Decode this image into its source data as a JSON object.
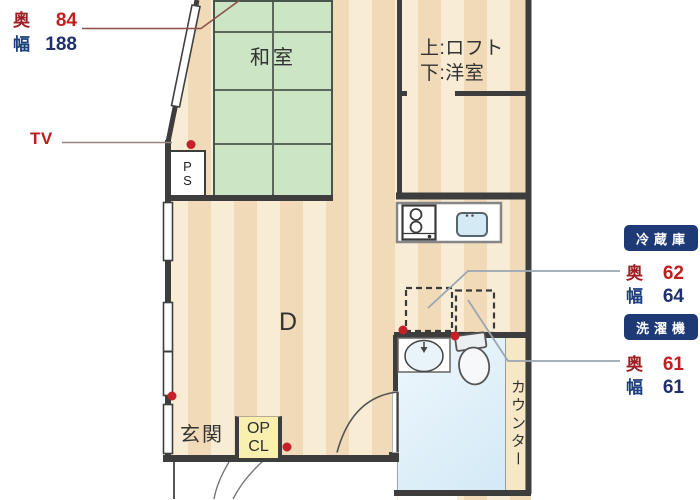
{
  "rooms": {
    "tatami": "和室",
    "loft_line1": "上:ロフト",
    "loft_line2": "下:洋室",
    "dining": "D",
    "entrance": "玄関",
    "counter_vertical": "カウンター"
  },
  "boxes": {
    "pipe_space": {
      "line1": "P",
      "line2": "S"
    },
    "entrance_closet": {
      "line1": "OP",
      "line2": "CL"
    }
  },
  "annotations": {
    "tv": "TV",
    "top_item": {
      "depth_label": "奥",
      "depth_value": "84",
      "width_label": "幅",
      "width_value": "188"
    },
    "fridge": {
      "badge": "冷蔵庫",
      "depth_label": "奥",
      "depth_value": "62",
      "width_label": "幅",
      "width_value": "64"
    },
    "washer": {
      "badge": "洗濯機",
      "depth_label": "奥",
      "depth_value": "61",
      "width_label": "幅",
      "width_value": "61"
    }
  },
  "colors": {
    "badge_navy": "#1d3a76",
    "dimension_red": "#c31d1d",
    "dimension_blue": "#1d3f7d",
    "outlet_dot_red": "#c32127",
    "wall_gray": "#3d3d3d",
    "tatami_green": "#cbe5c5",
    "floor_light": "#f8ecd5",
    "floor_dark": "#f0dab8",
    "bath_blue": "#d9ecf8",
    "closet_yellow": "#f9efae"
  }
}
